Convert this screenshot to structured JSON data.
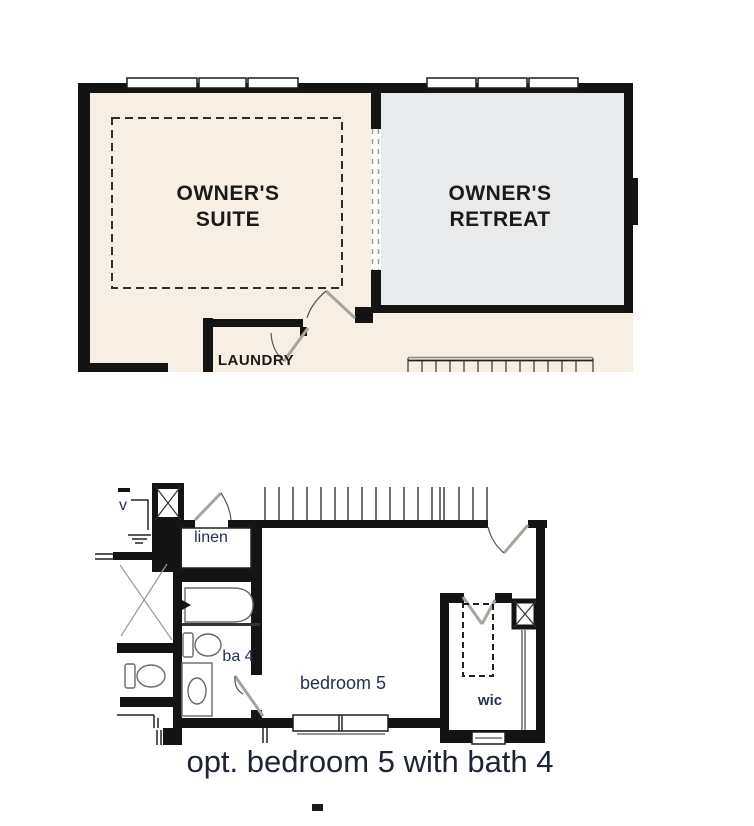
{
  "colors": {
    "wall": "#141414",
    "suite_fill": "#f7efe3",
    "retreat_fill": "#e8eaec",
    "room_label": "#1a1a1a",
    "lower_label": "#253052",
    "caption_color": "#1d2433",
    "door_leaf": "#a8a49d",
    "thin_line": "#555555"
  },
  "upper_plan": {
    "owners_suite": {
      "line1": "OWNER'S",
      "line2": "SUITE"
    },
    "owners_retreat": {
      "line1": "OWNER'S",
      "line2": "RETREAT"
    },
    "laundry": "LAUNDRY"
  },
  "lower_plan": {
    "linen": "linen",
    "bath": "ba 4",
    "bedroom": "bedroom 5",
    "closet": "wic",
    "vent": "v"
  },
  "caption": "opt. bedroom 5 with bath 4"
}
